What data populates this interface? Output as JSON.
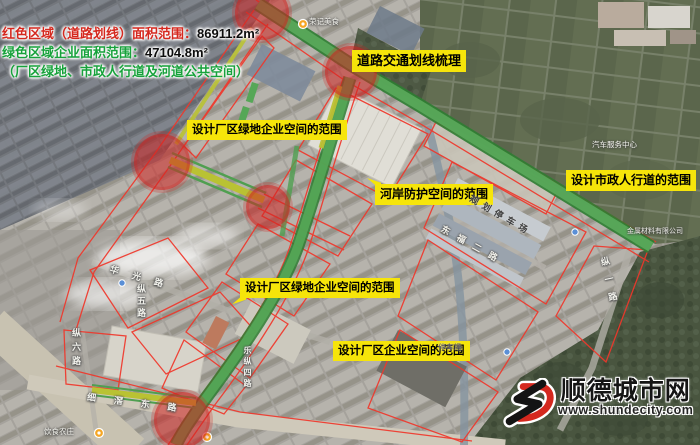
{
  "legend": {
    "line1_label": "红色区域（道路划线）面积范围：",
    "line1_value": "86911.2m²",
    "line2_label": "绿色区域企业面积范围：",
    "line2_value": "47104.8m²",
    "line3": "（厂区绿地、市政人行道及河道公共空间）"
  },
  "annotations": {
    "label_bg_color": "#f6e50a",
    "labels": [
      {
        "id": "road-traffic-marking",
        "text": "道路交通划线梳理"
      },
      {
        "id": "factory-green-space-upper",
        "text": "设计厂区绿地企业空间的范围"
      },
      {
        "id": "riverbank-protection",
        "text": "河岸防护空间的范围"
      },
      {
        "id": "municipal-sidewalk",
        "text": "设计市政人行道的范围"
      },
      {
        "id": "factory-green-space-lower",
        "text": "设计厂区绿地企业空间的范围"
      },
      {
        "id": "factory-enterprise-space",
        "text": "设计厂区企业空间的范围"
      }
    ]
  },
  "map_labels": {
    "roads": [
      {
        "name": "华光路"
      },
      {
        "name": "纵五路"
      },
      {
        "name": "纵六路"
      },
      {
        "name": "乐纵四路"
      },
      {
        "name": "细滘东路"
      },
      {
        "name": "东福二路"
      },
      {
        "name": "纵一路"
      },
      {
        "name": "规划停车场"
      }
    ],
    "pois": [
      {
        "name": "荣记美食"
      },
      {
        "name": "汽车服务中心"
      },
      {
        "name": "金属材料有限公司"
      },
      {
        "name": "停车场"
      },
      {
        "name": "饮食农庄"
      }
    ]
  },
  "watermark": {
    "site_name": "顺德城市网",
    "url": "www.shundecity.com"
  },
  "colors": {
    "legend_red": "#d5281e",
    "legend_green": "#17a23b",
    "annotation_yellow": "#f6e50a",
    "red_circle": "#cf2320",
    "red_boundary": "#f0372b",
    "green_corridor": "#4f9f50",
    "olive_corridor": "#b9c233",
    "watermark_red": "#d5281e"
  }
}
